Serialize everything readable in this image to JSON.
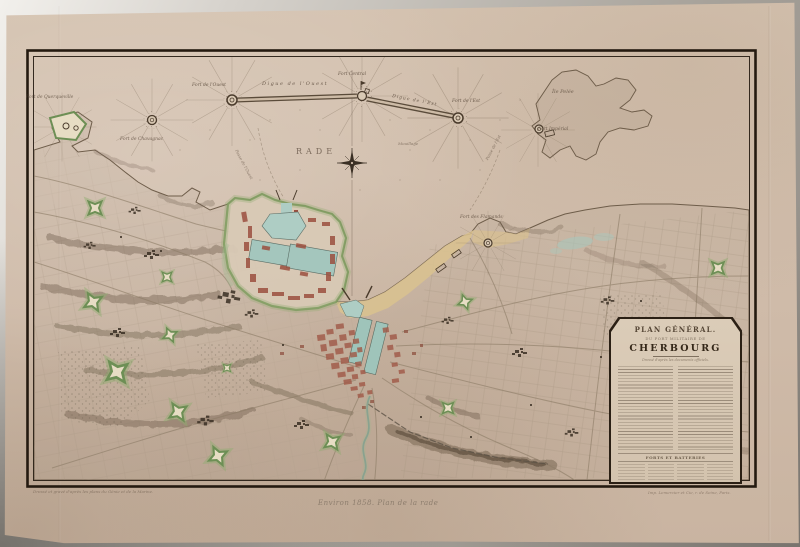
{
  "cartouche": {
    "title": "PLAN GÉNÉRAL.",
    "subtitle": "DU PORT MILITAIRE DE",
    "city": "CHERBOURG",
    "subtitle2": "Dressé d'après les documents officiels.",
    "section_header": "FORTS ET BATTERIES",
    "scale_note": "Échelle de 1 à 20 000."
  },
  "labels": [
    {
      "name": "fort-querqueville",
      "text": "Fort de Querqueville"
    },
    {
      "name": "fort-chavagnac",
      "text": "Fort de Chavagnac"
    },
    {
      "name": "fort-ouest",
      "text": "Fort de l'Ouest"
    },
    {
      "name": "digue-ouest",
      "text": "Digue de l'Ouest"
    },
    {
      "name": "fort-central",
      "text": "Fort Central"
    },
    {
      "name": "digue-est",
      "text": "Digue de l'Est"
    },
    {
      "name": "fort-est",
      "text": "Fort de l'Est"
    },
    {
      "name": "ile-pelee",
      "text": "Île Pelée"
    },
    {
      "name": "fort-imperial",
      "text": "Fort Impérial"
    },
    {
      "name": "rade",
      "text": "RADE"
    },
    {
      "name": "mouillage",
      "text": "Mouillage"
    },
    {
      "name": "passe-ouest",
      "text": "Passe de l'Ouest"
    },
    {
      "name": "passe-est",
      "text": "Passe de l'Est"
    },
    {
      "name": "fort-flamands",
      "text": "Fort des Flamands"
    }
  ],
  "imprints": {
    "left": "Dressé et gravé d'après les plans du Génie et de la Marine.",
    "right": "Imp. Lemercier et Cie, r. de Seine, Paris."
  },
  "pencil_note": "Environ 1858. Plan de la rade",
  "colors": {
    "paper": "#d0bcaa",
    "backdrop_gray": "#a9a49c",
    "frame_ink": "#241a10",
    "water_basin": "#a4c6bd",
    "sand_beach": "#d9c190",
    "town_red": "#a05a48",
    "fort_green": "#8fae6f",
    "hachure_brown": "#6f5f4c"
  }
}
